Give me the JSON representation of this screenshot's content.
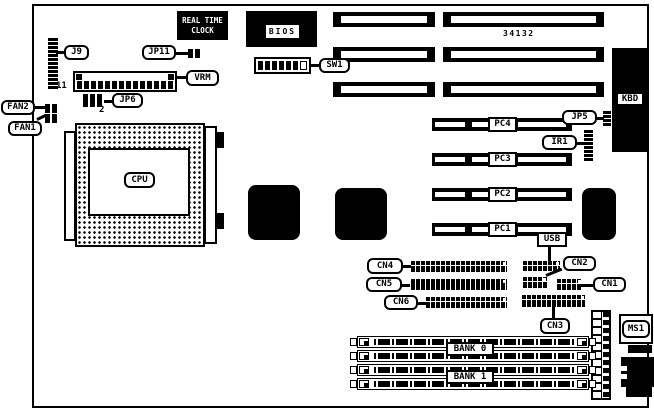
{
  "board": {
    "cpu": {
      "label": "CPU"
    },
    "rtc": {
      "lines": [
        "REAL TIME",
        "CLOCK"
      ]
    },
    "bios": {
      "label": "BIOS"
    },
    "part_number": "34132",
    "markers": {
      "j9_pin": "11",
      "jp6_pin": "2"
    },
    "connectors": {
      "j9": "J9",
      "jp11": "JP11",
      "vrm": "VRM",
      "jp6": "JP6",
      "fan2": "FAN2",
      "fan1": "FAN1",
      "sw1": "SW1",
      "kbd": "KBD",
      "jp5": "JP5",
      "ir1": "IR1",
      "usb": "USB",
      "cn1": "CN1",
      "cn2": "CN2",
      "cn3": "CN3",
      "cn4": "CN4",
      "cn5": "CN5",
      "cn6": "CN6",
      "ms1": "MS1"
    },
    "slots": {
      "pci": [
        {
          "label": "PC4"
        },
        {
          "label": "PC3"
        },
        {
          "label": "PC2"
        },
        {
          "label": "PC1"
        }
      ],
      "memory_banks": [
        {
          "label": "BANK 0"
        },
        {
          "label": "BANK 1"
        }
      ]
    },
    "colors": {
      "ink": "#000000",
      "paper": "#ffffff"
    }
  }
}
